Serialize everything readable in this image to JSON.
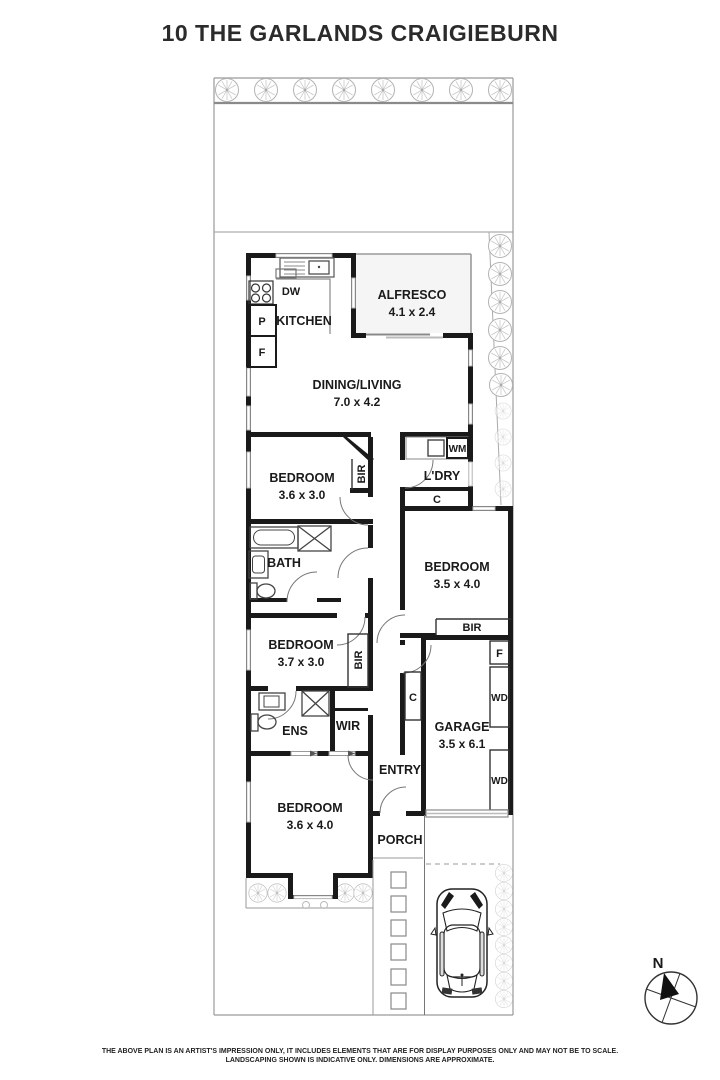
{
  "title": "10 THE GARLANDS CRAIGIEBURN",
  "rooms": {
    "alfresco": {
      "name": "ALFRESCO",
      "dims": "4.1 x 2.4"
    },
    "dining": {
      "name": "DINING/LIVING",
      "dims": "7.0 x 4.2"
    },
    "kitchen": {
      "name": "KITCHEN"
    },
    "bedroom1": {
      "name": "BEDROOM",
      "dims": "3.6 x 3.0"
    },
    "bedroom2": {
      "name": "BEDROOM",
      "dims": "3.5 x 4.0"
    },
    "bedroom3": {
      "name": "BEDROOM",
      "dims": "3.7 x 3.0"
    },
    "bedroom4": {
      "name": "BEDROOM",
      "dims": "3.6 x 4.0"
    },
    "garage": {
      "name": "GARAGE",
      "dims": "3.5 x 6.1"
    },
    "bath": {
      "name": "BATH"
    },
    "ens": {
      "name": "ENS"
    },
    "wir": {
      "name": "WIR"
    },
    "laundry": {
      "name": "L'DRY"
    },
    "entry": {
      "name": "ENTRY"
    },
    "porch": {
      "name": "PORCH"
    }
  },
  "fixtures": {
    "dishwasher": "DW",
    "pantry": "P",
    "fridge_kitchen": "F",
    "washing_machine": "WM",
    "linen_cupboard": "C",
    "bir_bed1": "BIR",
    "bir_bed2": "BIR",
    "bir_bed3": "BIR",
    "fridge_garage": "F",
    "wd_upper": "WD",
    "wd_lower": "WD",
    "hall_cupboard": "C"
  },
  "compass": {
    "north": "N"
  },
  "disclaimer": {
    "line1": "THE ABOVE PLAN IS AN ARTIST'S IMPRESSION ONLY, IT INCLUDES ELEMENTS THAT ARE FOR DISPLAY PURPOSES ONLY AND MAY NOT BE TO SCALE.",
    "line2": "LANDSCAPING SHOWN IS INDICATIVE ONLY. DIMENSIONS ARE APPROXIMATE."
  },
  "colors": {
    "wall": "#1a1a1a",
    "boundary": "#9a9a9a",
    "window": "#c4c4c4",
    "text": "#1a1a1a"
  }
}
